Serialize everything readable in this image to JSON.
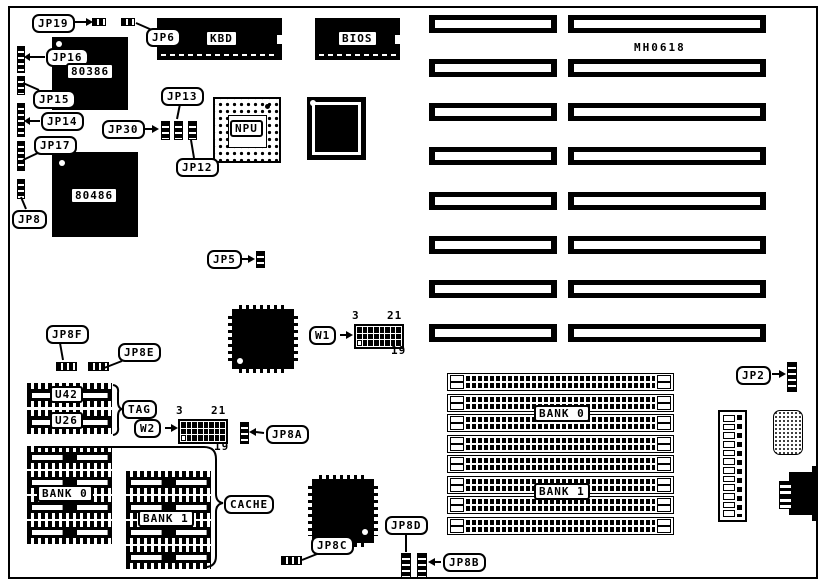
{
  "diagram": {
    "part_number": "MH0618",
    "colors": {
      "ink": "#000000",
      "paper": "#ffffff"
    },
    "chips": {
      "kbd": "KBD",
      "bios": "BIOS",
      "cpu386": "80386",
      "cpu486": "80486",
      "npu": "NPU"
    },
    "cache": {
      "u42": "U42",
      "u26": "U26",
      "tag": "TAG",
      "cache": "CACHE"
    },
    "memory": {
      "bank0_left": "BANK 0",
      "bank1_left": "BANK 1",
      "bank0_right": "BANK 0",
      "bank1_right": "BANK 1"
    },
    "jumpers": {
      "jp19": "JP19",
      "jp6": "JP6",
      "jp16": "JP16",
      "jp15": "JP15",
      "jp14": "JP14",
      "jp17": "JP17",
      "jp8": "JP8",
      "jp30": "JP30",
      "jp13": "JP13",
      "jp12": "JP12",
      "jp5": "JP5",
      "jp2": "JP2",
      "jp8a": "JP8A",
      "jp8b": "JP8B",
      "jp8c": "JP8C",
      "jp8d": "JP8D",
      "jp8e": "JP8E",
      "jp8f": "JP8F",
      "w1": "W1",
      "w2": "W2"
    },
    "pin_numbers": {
      "w1_top_left": "3",
      "w1_top_right": "21",
      "w1_bottom_right": "19",
      "w2_top_left": "3",
      "w2_top_right": "21",
      "w2_bottom_right": "19"
    }
  }
}
